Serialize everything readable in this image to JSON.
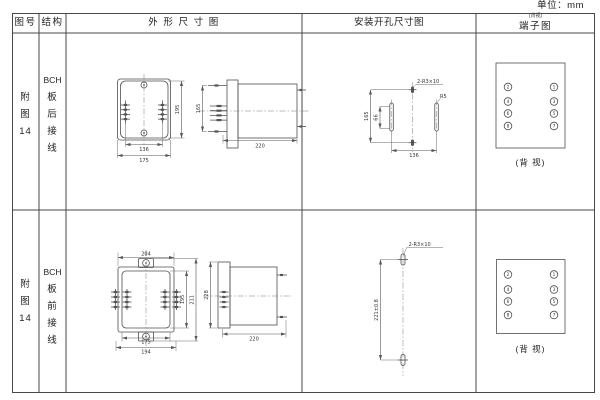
{
  "unit_label": "单位：mm",
  "colors": {
    "ink": "#4f4f4f",
    "paper": "#ffffff"
  },
  "header": {
    "figure": "图号",
    "structure": "结构",
    "outline": "外 形 尺 寸 图",
    "mounting": "安装开孔尺寸图",
    "terminal": "端子图",
    "terminal_note": "(背视)"
  },
  "rows": [
    {
      "figure_chars": [
        "附",
        "图",
        "14"
      ],
      "structure_chars": [
        "BCH",
        "板",
        "后",
        "接",
        "线"
      ],
      "outline": {
        "front": {
          "height": "195",
          "inner_width": "136",
          "outer_width": "175"
        },
        "side": {
          "height": "165",
          "depth": "220"
        }
      },
      "mounting": {
        "holes_label": "2-R3×10",
        "radius_label": "R5",
        "height": "165",
        "slot_height": "66",
        "width": "136"
      },
      "terminal": {
        "left": [
          "2",
          "4",
          "6",
          "8"
        ],
        "right": [
          "1",
          "3",
          "5",
          "7"
        ],
        "caption": "(背 视)"
      }
    },
    {
      "figure_chars": [
        "附",
        "图",
        "14"
      ],
      "structure_chars": [
        "BCH",
        "板",
        "前",
        "接",
        "线"
      ],
      "outline": {
        "front": {
          "top_width": "204",
          "height_inner": "195",
          "height_outer": "211",
          "bottom_width_inner": "175",
          "bottom_width_outer": "194"
        },
        "side": {
          "height": "228",
          "depth": "220"
        }
      },
      "mounting": {
        "holes_label": "2-R3×10",
        "height": "221±0.8"
      },
      "terminal": {
        "left": [
          "2",
          "4",
          "6",
          "8"
        ],
        "right": [
          "1",
          "3",
          "5",
          "7"
        ],
        "caption": "(背 视)"
      }
    }
  ]
}
